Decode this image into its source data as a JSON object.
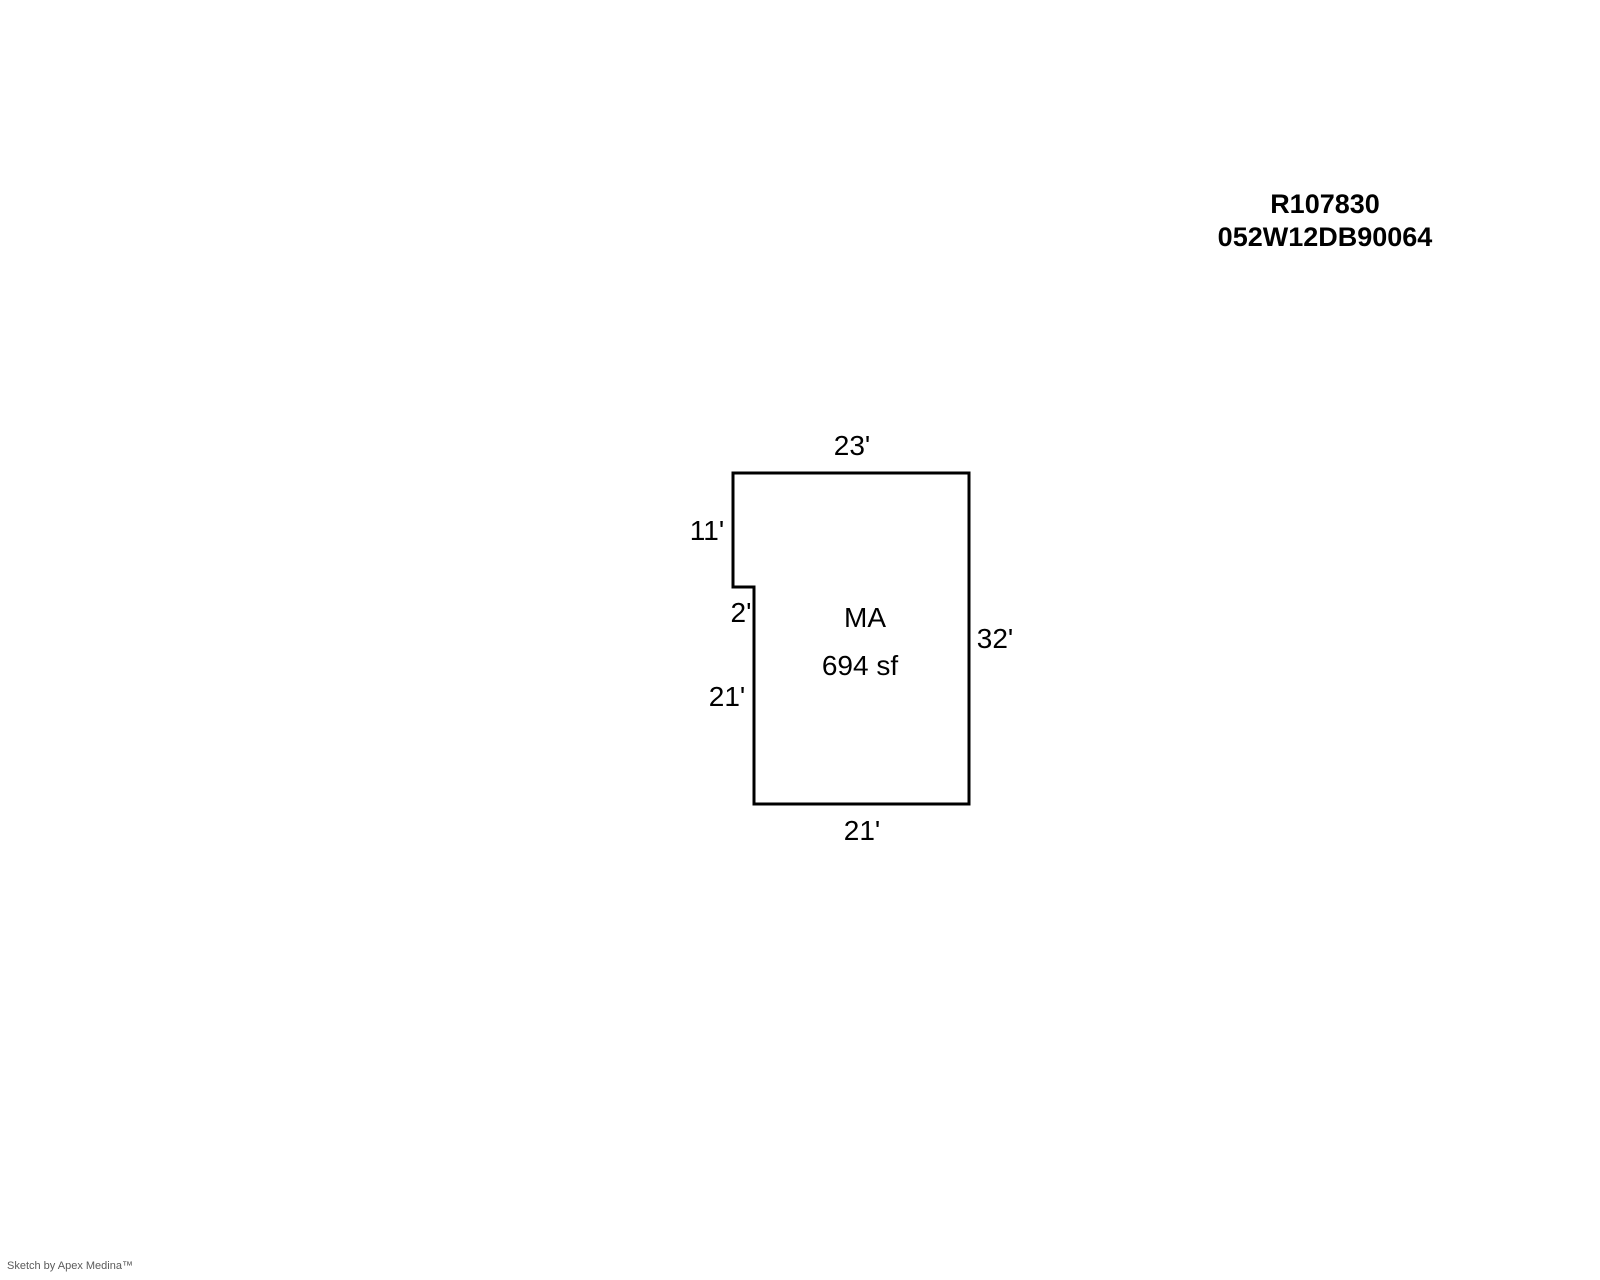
{
  "header": {
    "record_id": "R107830",
    "parcel_id": "052W12DB90064"
  },
  "floorplan": {
    "polygon_points": "733,473 969,473 969,804 754,804 754,587 733,587",
    "stroke_color": "#000000",
    "area": {
      "code": "MA",
      "size": "694 sf"
    },
    "dimensions": [
      {
        "side": "top",
        "label": "23'"
      },
      {
        "side": "upper-left",
        "label": "11'"
      },
      {
        "side": "notch-left",
        "label": "2'"
      },
      {
        "side": "lower-left",
        "label": "21'"
      },
      {
        "side": "right",
        "label": "32'"
      },
      {
        "side": "bottom",
        "label": "21'"
      }
    ]
  },
  "footer": {
    "credit": "Sketch by Apex Medina™"
  }
}
